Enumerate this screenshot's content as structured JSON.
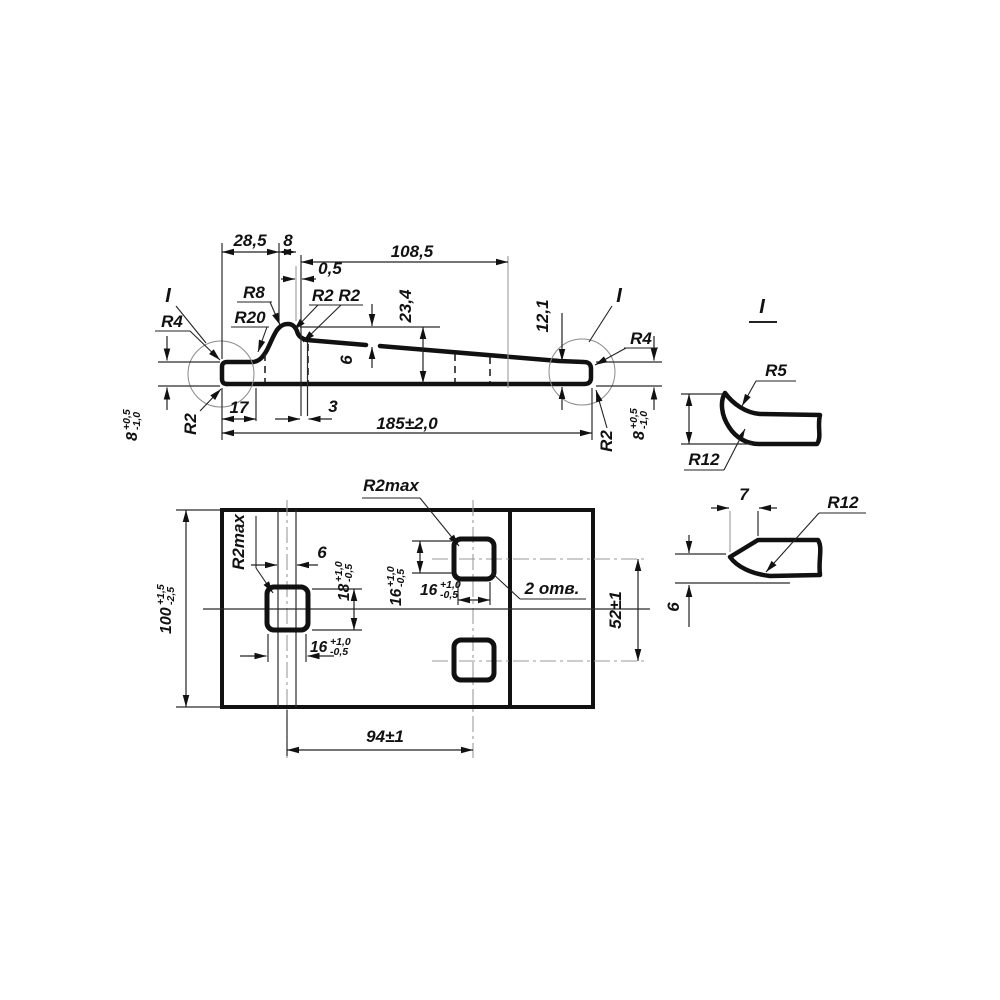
{
  "side": {
    "dims": {
      "w28_5": "28,5",
      "w8": "8",
      "w108_5": "108,5",
      "w0_5": "0,5",
      "h23_4": "23,4",
      "h12_1": "12,1",
      "t6": "6",
      "w17": "17",
      "w3": "3",
      "total": "185±2,0"
    },
    "radii": {
      "r4_left": "R4",
      "r4_right": "R4",
      "r8": "R8",
      "r20": "R20",
      "r2_pair": "R2 R2",
      "r2_left": "R2",
      "r2_right": "R2"
    },
    "detail_marks": {
      "left": "I",
      "right": "I"
    },
    "thickness_left": {
      "base": "8",
      "plus": "+0,5",
      "minus": "-1,0"
    },
    "thickness_right": {
      "base": "8",
      "plus": "+0,5",
      "minus": "-1,0"
    }
  },
  "plan": {
    "dims": {
      "height100": {
        "base": "100",
        "plus": "+1,5",
        "minus": "-2,5"
      },
      "band6": "6",
      "hole18": {
        "base": "18",
        "plus": "+1,0",
        "minus": "-0,5"
      },
      "hole16_left": {
        "base": "16",
        "plus": "+1,0",
        "minus": "-0,5"
      },
      "hole16_right_h": {
        "base": "16",
        "plus": "+1,0",
        "minus": "-0,5"
      },
      "hole16_right_v": {
        "base": "16",
        "plus": "+1,0",
        "minus": "-0,5"
      },
      "spacing52": "52±1",
      "spacing94": "94±1"
    },
    "radii": {
      "r2max_left": "R2max",
      "r2max_right": "R2max"
    },
    "holes_note": "2 отв."
  },
  "detail_i": {
    "title": "I",
    "r5": "R5",
    "r12": "R12"
  },
  "detail_tip": {
    "nose7": "7",
    "r12": "R12",
    "h6": "6"
  }
}
